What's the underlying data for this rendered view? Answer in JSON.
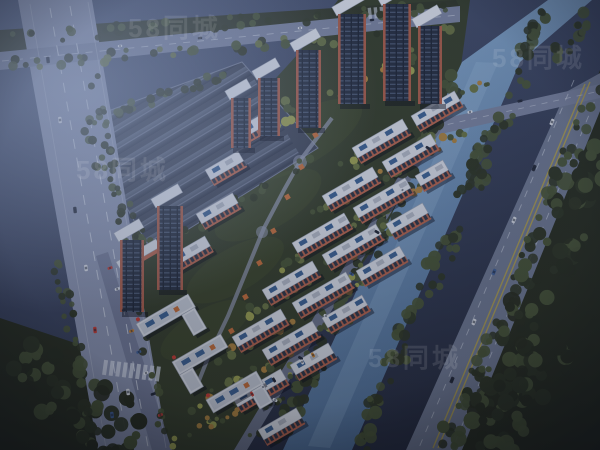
{
  "title": "aerial-dusk-render-residential-complex",
  "watermark": {
    "text": "58同城",
    "color": "#ffffff",
    "opacity": 0.1
  },
  "scene": {
    "setting": "dusk aerial 3D architectural rendering",
    "description": "Bird's-eye dusk rendering of a large residential compound: red-orange high-rise towers at the top, rows of mid-rise apartment slabs with white roofs and solar panels, a landscaped central park axis with orange pavilions, street-front commercial buildings and parking along the left arterial road, grey gabled warehouse rows at the upper left, a tree-lined canal crossed by a bridge on the right, a second arterial road beyond the canal, and dense dark forest in the corners, all under a hazy blue evening light.",
    "regions": [
      "left-arterial-road",
      "top-road",
      "warehouse-district",
      "residential-compound",
      "high-rise-towers",
      "apartment-slabs",
      "central-park-axis",
      "commercial-street-front",
      "canal",
      "canal-bridge",
      "right-arterial-road",
      "forest",
      "fog-haze"
    ]
  },
  "colors": {
    "bgTop": "#4a5674",
    "bgMid": "#39425c",
    "bgDark": "#242a3c",
    "fog": "#9fb0d2",
    "roadLeft": "#8790ab",
    "road": "#78819c",
    "roadRight": "#6e7890",
    "laneWhite": "#ccd3e0",
    "laneYellow": "#b3a24a",
    "boundaryRoad": "#6a7288",
    "frontage": "#707894",
    "pathGrey": "#8d94aa",
    "canalTop": "#8db0d2",
    "canalBottom": "#4a6a92",
    "waterHighlight": "#a8c8e2",
    "treeDark": "#2c3320",
    "treeMid": "#465232",
    "treeLight": "#66713f",
    "treeYellow": "#989d4c",
    "treeOrange": "#a97f3a",
    "forest": "#262b1b",
    "ground": "#333b26",
    "groundLight": "#414b2b",
    "warehouse": "#3a4152",
    "warehouseLight": "#5a6479",
    "warehouseDark": "#2d3445",
    "wall": "#6f7890",
    "roofWhite": "#d7dbe3",
    "roofGrey": "#aeb4c0",
    "roofEdge": "#9aa1b0",
    "panelBlue": "#3a5f8f",
    "facadeOrange": "#b4624a",
    "windowDark": "#2c3240",
    "towerGlass": "#232b3b",
    "towerLine": "#46536b",
    "towerOrange": "#a85a44",
    "capWhite": "#dde1e9",
    "shadow": "rgba(6,9,20,0.45)",
    "pavilion": "#c06a35",
    "carRed": "#c23a30",
    "carWhite": "#d9dde5",
    "carDark": "#232836",
    "carBlue": "#3f5f95",
    "carOrange": "#c57f2e",
    "tintTop": "rgba(70,90,140,0.15)",
    "tintBottom": "rgba(15,18,30,0.28)",
    "vignette": "rgba(8,11,22,0.55)"
  }
}
